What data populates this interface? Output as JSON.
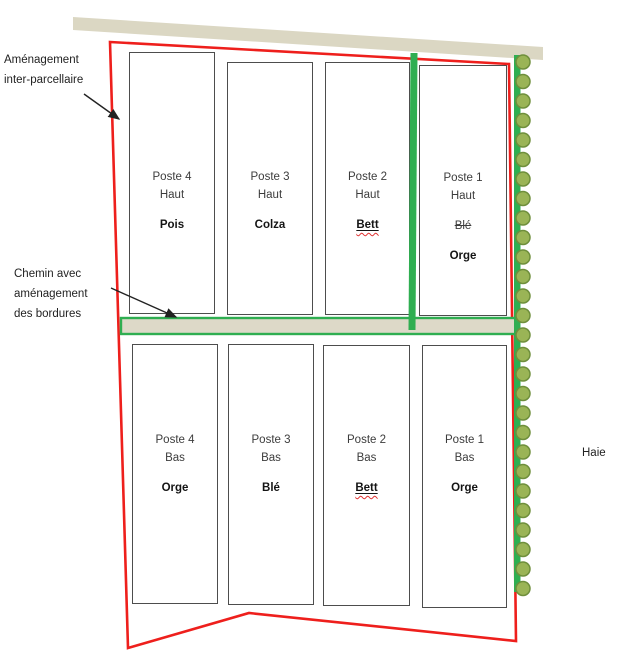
{
  "colors": {
    "boundary_red": "#ee1f1c",
    "path_green": "#2fae51",
    "road_beige": "#dbd7c3",
    "chemin_fill": "#ddd9c8",
    "hedge_fill": "#9ab456",
    "hedge_stroke": "#6f8f3c",
    "plot_border": "#4d4d4d",
    "text_dark": "#3c3c3c",
    "crop_text": "#141414",
    "wavy_red": "#e03131",
    "annot_text": "#222222"
  },
  "annotations": {
    "inter_parcel": {
      "line1": "Aménagement",
      "line2": "inter-parcellaire"
    },
    "chemin": {
      "line1": "Chemin avec",
      "line2": "aménagement",
      "line3": "des bordures"
    },
    "haie": "Haie"
  },
  "plots": [
    {
      "title": "Poste 4",
      "row": "Haut",
      "crop": "Pois"
    },
    {
      "title": "Poste 3",
      "row": "Haut",
      "crop": "Colza"
    },
    {
      "title": "Poste 2",
      "row": "Haut",
      "crop": "Bett"
    },
    {
      "title": "Poste 1",
      "row": "Haut",
      "struck_crop": "Blé",
      "crop": "Orge"
    },
    {
      "title": "Poste 4",
      "row": "Bas",
      "crop": "Orge"
    },
    {
      "title": "Poste 3",
      "row": "Bas",
      "crop": "Blé"
    },
    {
      "title": "Poste 2",
      "row": "Bas",
      "crop": "Bett"
    },
    {
      "title": "Poste 1",
      "row": "Bas",
      "crop": "Orge"
    }
  ]
}
